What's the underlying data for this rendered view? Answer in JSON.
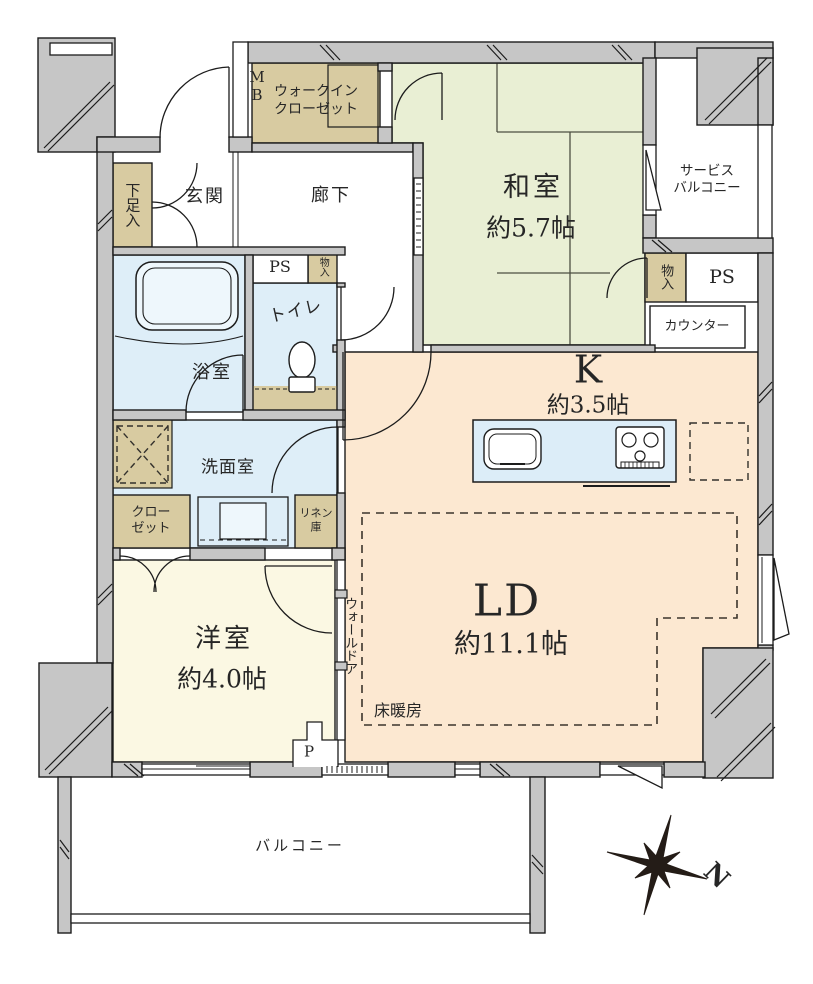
{
  "colors": {
    "wall_gray": "#c6c6c6",
    "tatami_room_green": "#e9efd4",
    "living_peach": "#fce8d1",
    "western_room_cream": "#fbf8e3",
    "wet_area_blue": "#deeef8",
    "storage_tan": "#d8cba1",
    "kitchen_counter_blue": "#dcedf8",
    "line_black": "#1c1c1c"
  },
  "labels": {
    "washitsu_name": "和室",
    "washitsu_size": "約5.7帖",
    "ld_name": "LD",
    "ld_size": "約11.1帖",
    "k_name": "K",
    "k_size": "約3.5帖",
    "yoshitsu_name": "洋室",
    "yoshitsu_size": "約4.0帖",
    "genkan": "玄関",
    "rouka": "廊下",
    "yokushitsu": "浴室",
    "toire": "トイレ",
    "senmen": "洗面室",
    "wic_line1": "ウォークイン",
    "wic_line2": "クローゼット",
    "sb_line1": "サービス",
    "sb_line2": "バルコニー",
    "balcony": "バルコニー",
    "closet_line1": "クロー",
    "closet_line2": "ゼット",
    "linen_line1": "リネン",
    "linen_line2": "庫",
    "getabako": "下足入",
    "monoiri_hall": "物入",
    "monoiri_k": "物入",
    "mb_line1": "M",
    "mb_line2": "B",
    "ps_hall": "PS",
    "ps_east": "PS",
    "counter": "カウンター",
    "wall_door": "ウォールドア",
    "yukadanbou": "床暖房",
    "pipe": "P",
    "north": "N"
  }
}
